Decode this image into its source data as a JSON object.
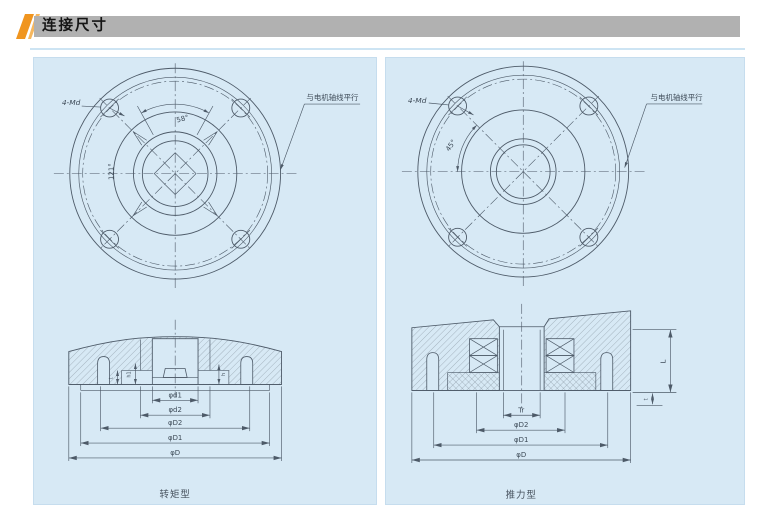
{
  "header": {
    "title": "连接尺寸"
  },
  "left_panel": {
    "caption": "转矩型",
    "bolt_label": "4-Md",
    "angle_top": "58°",
    "angle_left": "121°",
    "note": "与电机轴线平行",
    "dims": {
      "d1": "φd1",
      "d2": "φd2",
      "D2": "φD2",
      "D1": "φD1",
      "D": "φD"
    },
    "small_dims": {
      "t": "t",
      "h1": "h1",
      "h": "h"
    }
  },
  "right_panel": {
    "caption": "推力型",
    "bolt_label": "4-Md",
    "angle": "45°",
    "note": "与电机轴线平行",
    "dims": {
      "Tr": "Tr",
      "D2": "φD2",
      "D1": "φD1",
      "D": "φD"
    },
    "small_dims": {
      "L": "L",
      "t": "t"
    }
  },
  "colors": {
    "accent_orange": "#f0951f",
    "header_bar": "#b1b1b1",
    "panel_bg": "#d7e9f5",
    "line": "#4d5a68"
  }
}
